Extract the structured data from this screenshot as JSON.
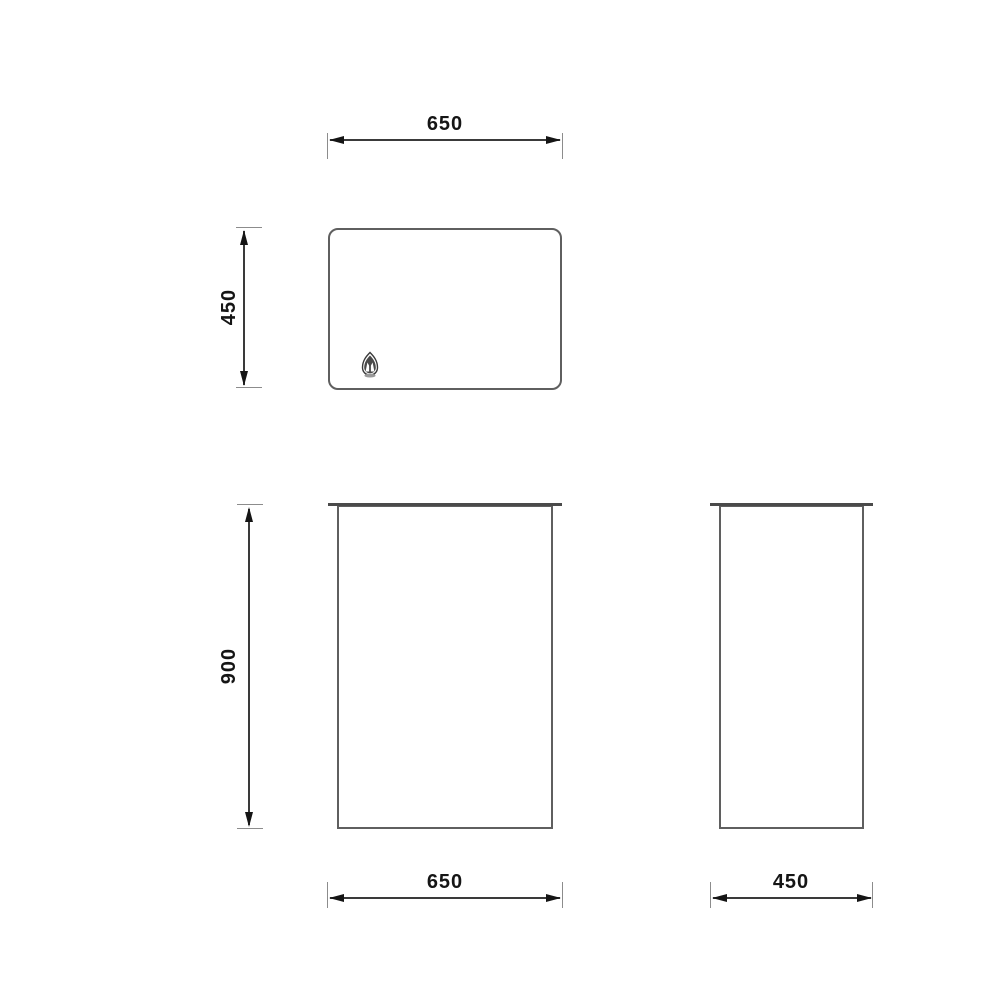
{
  "drawing": {
    "type": "furniture-orthographic-technical-drawing",
    "dimensions": {
      "top_width": "650",
      "top_depth": "450",
      "height": "900",
      "front_width": "650",
      "side_depth": "450"
    }
  },
  "icons": {
    "logo": "brand-crest-icon"
  },
  "colors": {
    "background": "#ffffff",
    "view_outline": "#5f5f5f",
    "top_edge_line": "#4a4a4a",
    "dimension_line": "#3a3a3a",
    "extension_line": "#8c8c8c",
    "arrowhead": "#151515",
    "label_text": "#151515"
  }
}
